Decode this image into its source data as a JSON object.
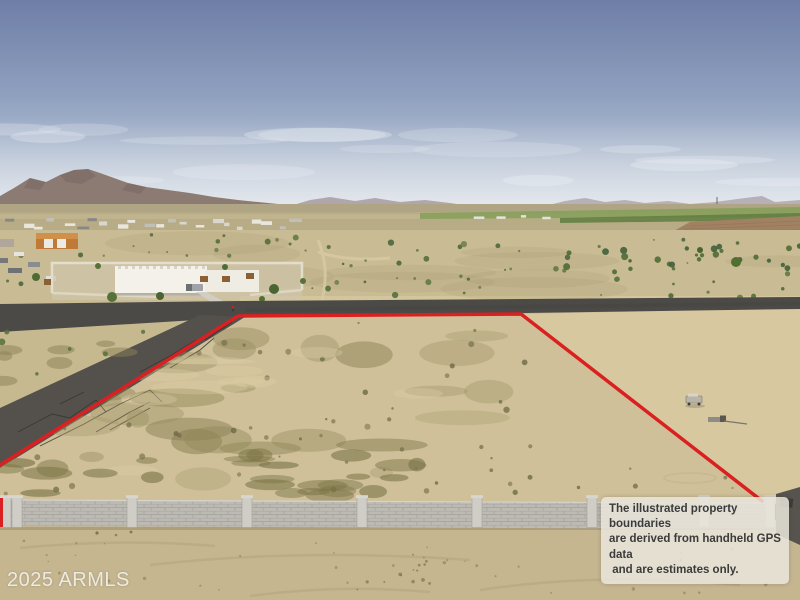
{
  "photo": {
    "type": "aerial-drone-photo",
    "subject": "vacant desert land parcel outlined in red with block wall, road, house and mountains",
    "watermark": {
      "text": "2025 ARMLS"
    },
    "disclaimer": {
      "lines": [
        "The illustrated property boundaries",
        "are derived from handheld GPS data",
        " and are estimates only."
      ]
    },
    "boundary": {
      "color": "#da2020",
      "points": "0,465 238,316 521,314 762,501",
      "tick": {
        "x": 1.5,
        "y1": 498,
        "y2": 527
      }
    },
    "palette": {
      "sky_top": "#6e7ea7",
      "sky_horizon": "#ccd4dd",
      "mountains": "#8c7b73",
      "far_range": "#a79da6",
      "plain": "#b7ac86",
      "farmland": "#87a05b",
      "tilled_field": "#a08162",
      "desert": "#c9bc94",
      "lot_sand": "#cfc099",
      "neighbor_sand": "#d8c8a0",
      "scrub": "#8b8459",
      "asphalt": "#524f4a",
      "house": "#f3f1ea",
      "block_wall": "#bcbab3",
      "foreground_dirt": "#c5b690"
    }
  }
}
